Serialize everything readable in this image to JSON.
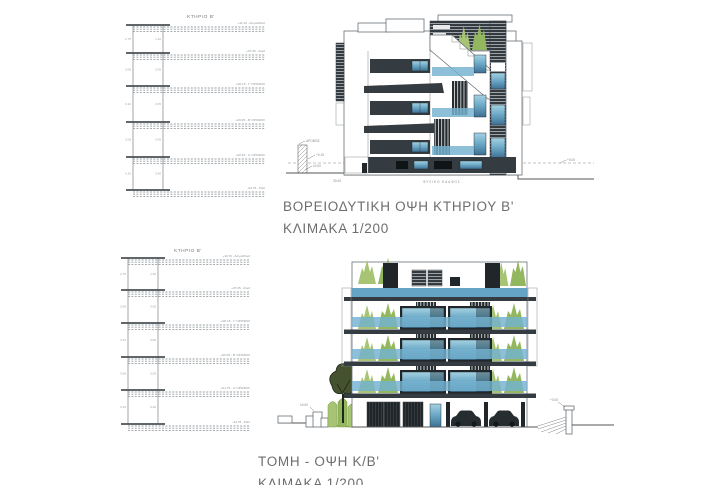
{
  "page": {
    "background": "#ffffff"
  },
  "colors": {
    "dark_band": "#343c41",
    "dark_deep": "#20262a",
    "glass_top": "#a4d2e3",
    "glass_bottom": "#3d6f94",
    "glass_rail": "#74b2cf",
    "green_light": "#a6c474",
    "green_dark": "#93b75f",
    "tree_dark": "#45522f",
    "line": "#666666",
    "title_text": "#6e6e6e"
  },
  "top_section": {
    "schematic": {
      "title": "ΚΤΗΡΙΟ Β'",
      "levels": [
        {
          "label": "+11.10 - Δώμα/Roof"
        },
        {
          "label": "+07.05 - Roof"
        },
        {
          "label": "+06.15 - Γ' ΟΡΟΦΟΣ"
        },
        {
          "label": "+03.05 - Β' ΟΡΟΦΟΣ"
        },
        {
          "label": "+00.15 - Α' ΟΡΟΦΟΣ"
        },
        {
          "label": "-04.75 - Pilot"
        }
      ],
      "dims_left": [
        "2.75",
        "3.06",
        "3.10",
        "3.06",
        "3.10"
      ],
      "dims_right": [
        "1.40",
        "3.05",
        "3.05",
        "3.05",
        "3.40"
      ]
    },
    "drawing": {
      "ground_label": "ΦΥΣΙΚΟ ΕΔΑΦΟΣ",
      "dim_label": "30.05",
      "markers": {
        "wall_top": "ΔΡΟΜΟΣ",
        "left_upper": "+0.15",
        "left_lower": "±0.00",
        "right": "+0.00"
      }
    },
    "caption": {
      "line1": "ΒΟΡΕΙΟΔΥΤΙΚΗ ΟΨΗ ΚΤΗΡΙΟΥ Β'",
      "line2": "ΚΛΙΜΑΚΑ 1/200"
    }
  },
  "bottom_section": {
    "schematic": {
      "title": "ΚΤΗΡΙΟ Β'",
      "levels": [
        {
          "label": "+10.70 - Δώμα/Roof"
        },
        {
          "label": "+07.05 - Roof"
        },
        {
          "label": "+06.15 - Γ' ΟΡΟΦΟΣ"
        },
        {
          "label": "+03.05 - Β' ΟΡΟΦΟΣ"
        },
        {
          "label": "+01.75 - Α' ΟΡΟΦΟΣ"
        },
        {
          "label": "-04.75 - Pilot"
        }
      ],
      "dims_left": [
        "2.75",
        "3.06",
        "3.10",
        "3.06",
        "3.10"
      ],
      "dims_right": [
        "1.40",
        "3.05",
        "3.05",
        "3.05",
        "3.40"
      ]
    },
    "drawing": {
      "markers": {
        "left": "±0.00",
        "right": "+0.00"
      }
    },
    "caption": {
      "line1": "ΤΟΜΗ - ΟΨΗ Κ/Β'",
      "line2": "ΚΛΙΜΑΚΑ 1/200"
    }
  }
}
